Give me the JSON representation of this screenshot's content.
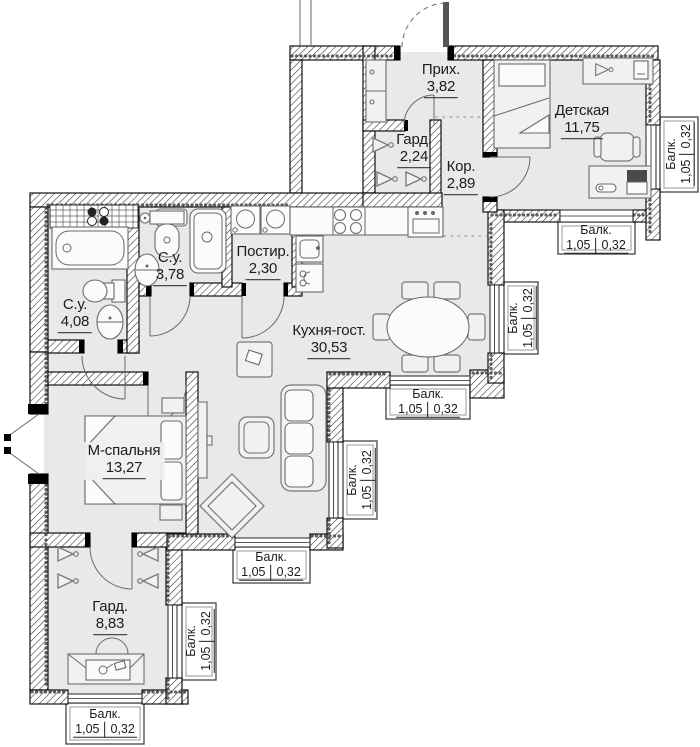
{
  "rooms": {
    "hallway": {
      "name": "Прих.",
      "area": "3,82"
    },
    "kids_room": {
      "name": "Детская",
      "area": "11,75"
    },
    "wardrobe_small": {
      "name": "Гард.",
      "area": "2,24"
    },
    "corridor": {
      "name": "Кор.",
      "area": "2,89"
    },
    "laundry": {
      "name": "Постир.",
      "area": "2,30"
    },
    "bathroom_small": {
      "name": "С.у.",
      "area": "3,78"
    },
    "bathroom_big": {
      "name": "С.у.",
      "area": "4,08"
    },
    "kitchen_living": {
      "name": "Кухня-гост.",
      "area": "30,53"
    },
    "master_bedroom": {
      "name": "М-спальня",
      "area": "13,27"
    },
    "wardrobe_big": {
      "name": "Гард.",
      "area": "8,83"
    }
  },
  "balcony": {
    "label": "Балк.",
    "dim_width": "1,05",
    "dim_depth": "0,32"
  },
  "colors": {
    "floor": "#e9e9e7",
    "wall_hatch": "#3c3c3c",
    "outline": "#111111",
    "furniture_line": "#777777"
  }
}
